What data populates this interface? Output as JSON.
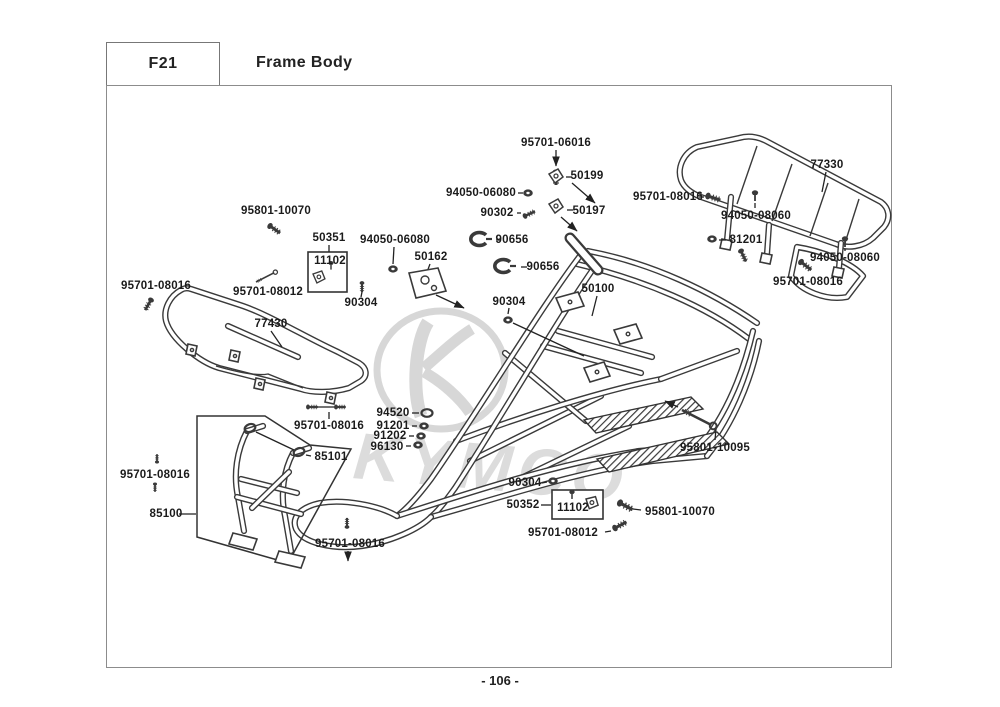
{
  "header": {
    "code": "F21",
    "title": "Frame Body"
  },
  "footer": {
    "page_number": "- 106 -"
  },
  "watermark": {
    "brand": "KYMCO"
  },
  "callouts": [
    {
      "text": "95701-06016",
      "x": 556,
      "y": 143
    },
    {
      "text": "50199",
      "x": 587,
      "y": 176
    },
    {
      "text": "94050-06080",
      "x": 481,
      "y": 193
    },
    {
      "text": "90302",
      "x": 497,
      "y": 213
    },
    {
      "text": "50197",
      "x": 589,
      "y": 211
    },
    {
      "text": "77330",
      "x": 827,
      "y": 165
    },
    {
      "text": "95701-08016",
      "x": 668,
      "y": 197
    },
    {
      "text": "94050-08060",
      "x": 756,
      "y": 216
    },
    {
      "text": "81201",
      "x": 746,
      "y": 240
    },
    {
      "text": "94050-08060",
      "x": 845,
      "y": 258
    },
    {
      "text": "95701-08016",
      "x": 808,
      "y": 282
    },
    {
      "text": "95801-10070",
      "x": 276,
      "y": 211
    },
    {
      "text": "50351",
      "x": 329,
      "y": 238
    },
    {
      "text": "11102",
      "x": 330,
      "y": 261
    },
    {
      "text": "94050-06080",
      "x": 395,
      "y": 240
    },
    {
      "text": "50162",
      "x": 431,
      "y": 257
    },
    {
      "text": "90656",
      "x": 512,
      "y": 240
    },
    {
      "text": "90656",
      "x": 543,
      "y": 267
    },
    {
      "text": "95701-08016",
      "x": 156,
      "y": 286
    },
    {
      "text": "95701-08012",
      "x": 268,
      "y": 292
    },
    {
      "text": "90304",
      "x": 361,
      "y": 303
    },
    {
      "text": "90304",
      "x": 509,
      "y": 302
    },
    {
      "text": "50100",
      "x": 598,
      "y": 289
    },
    {
      "text": "77430",
      "x": 271,
      "y": 324
    },
    {
      "text": "94520",
      "x": 393,
      "y": 413
    },
    {
      "text": "91201",
      "x": 393,
      "y": 426
    },
    {
      "text": "91202",
      "x": 390,
      "y": 436
    },
    {
      "text": "96130",
      "x": 387,
      "y": 447
    },
    {
      "text": "95701-08016",
      "x": 329,
      "y": 426
    },
    {
      "text": "85101",
      "x": 331,
      "y": 457
    },
    {
      "text": "95701-08016",
      "x": 155,
      "y": 475
    },
    {
      "text": "85100",
      "x": 166,
      "y": 514
    },
    {
      "text": "95801-10095",
      "x": 715,
      "y": 448
    },
    {
      "text": "90304",
      "x": 525,
      "y": 483
    },
    {
      "text": "50352",
      "x": 523,
      "y": 505
    },
    {
      "text": "11102",
      "x": 573,
      "y": 508
    },
    {
      "text": "95801-10070",
      "x": 680,
      "y": 512
    },
    {
      "text": "95701-08012",
      "x": 563,
      "y": 533
    },
    {
      "text": "95701-08016",
      "x": 350,
      "y": 544
    }
  ]
}
